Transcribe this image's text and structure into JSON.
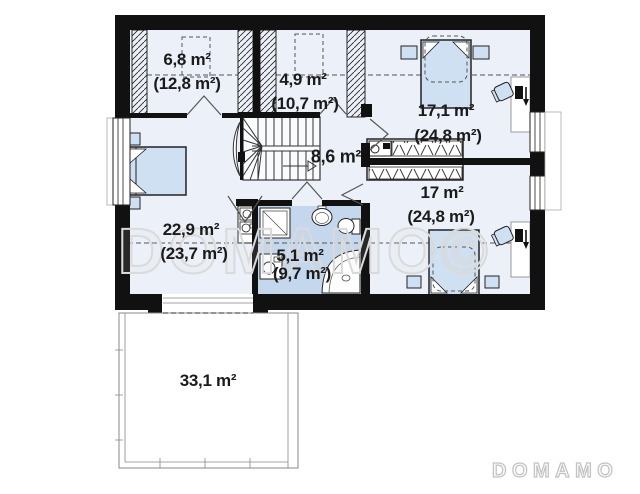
{
  "plan_type": "floor-plan-attic-storey",
  "rooms": [
    {
      "name": "room-top-left",
      "area": "6,8 m²",
      "total_area": "(12,8 m²)"
    },
    {
      "name": "room-top-middle",
      "area": "4,9 m²",
      "total_area": "(10,7 m²)"
    },
    {
      "name": "bedroom-top-right",
      "area": "17,1 m²",
      "total_area": "(24,8 m²)"
    },
    {
      "name": "hall-staircase",
      "area": "8,6 m²",
      "total_area": ""
    },
    {
      "name": "bedroom-bottom-right",
      "area": "17 m²",
      "total_area": "(24,8 m²)"
    },
    {
      "name": "bedroom-left",
      "area": "22,9 m²",
      "total_area": "(23,7 m²)"
    },
    {
      "name": "bathroom",
      "area": "5,1 m²",
      "total_area": "(9,7 m²)"
    },
    {
      "name": "terrace",
      "area": "33,1 m²",
      "total_area": ""
    }
  ],
  "watermarks": {
    "center": "DOMAMO©",
    "logo": "DOMAMO"
  },
  "colors": {
    "wall": "#111111",
    "floor": "#ecf1f9",
    "bathroom_floor": "#c5d7ec",
    "furniture": "#cfe0f2",
    "line": "#333333",
    "watermark": "#dadada"
  }
}
